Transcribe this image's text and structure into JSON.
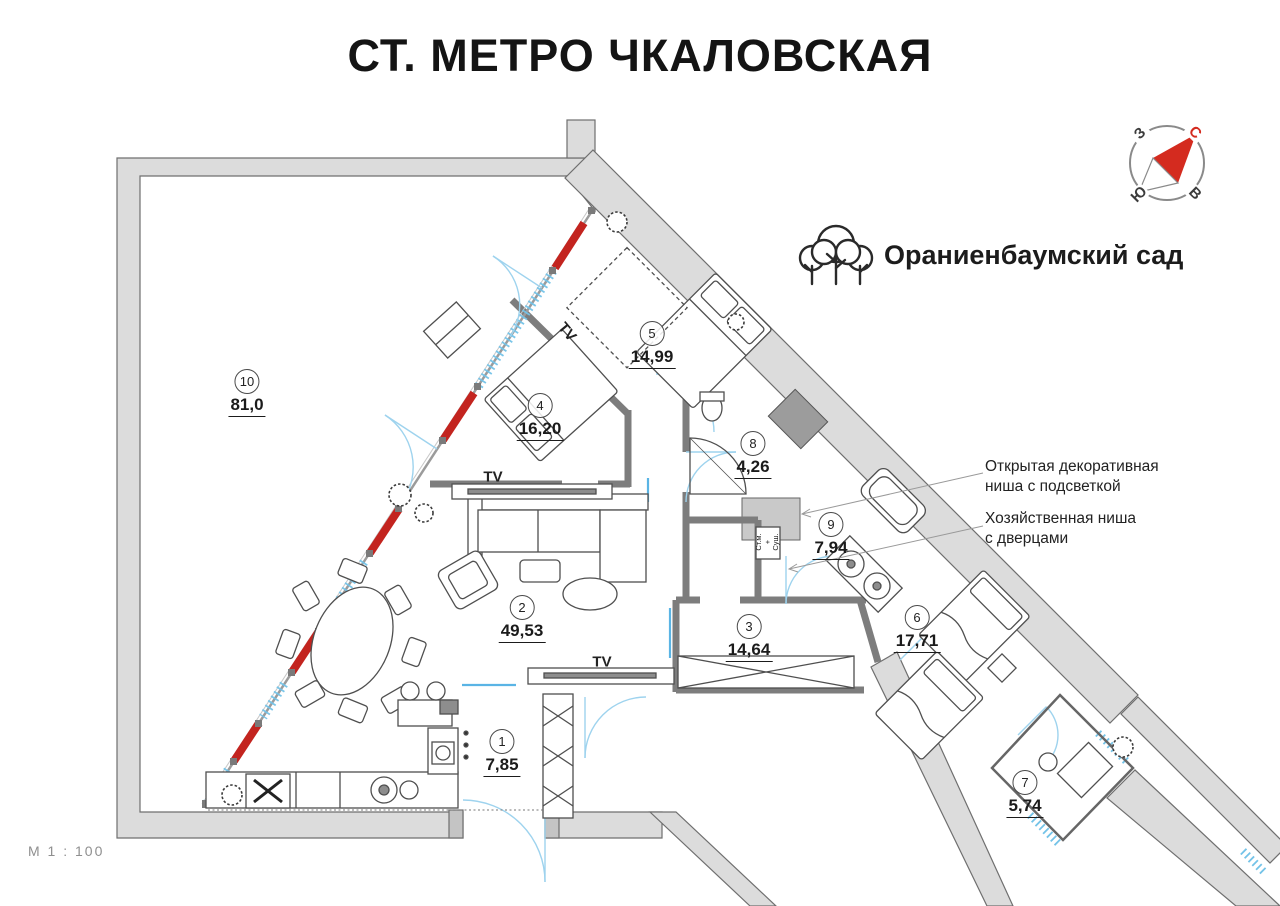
{
  "title": "СТ. МЕТРО ЧКАЛОВСКАЯ",
  "landmark": {
    "label": "Ораниенбаумский сад",
    "icon": "trees-icon"
  },
  "compass": {
    "north": "С",
    "south": "Ю",
    "west": "З",
    "east": "В"
  },
  "scale_note": "М 1 : 100",
  "rooms": [
    {
      "num": "1",
      "area": "7,85"
    },
    {
      "num": "2",
      "area": "49,53"
    },
    {
      "num": "3",
      "area": "14,64"
    },
    {
      "num": "4",
      "area": "16,20"
    },
    {
      "num": "5",
      "area": "14,99"
    },
    {
      "num": "6",
      "area": "17,71"
    },
    {
      "num": "7",
      "area": "5,74"
    },
    {
      "num": "8",
      "area": "4,26"
    },
    {
      "num": "9",
      "area": "7,94"
    },
    {
      "num": "10",
      "area": "81,0"
    }
  ],
  "annotations": [
    {
      "line1": "Открытая декоративная",
      "line2": "ниша с подсветкой"
    },
    {
      "line1": "Хозяйственная ниша",
      "line2": "с дверцами"
    }
  ],
  "equipment": {
    "tv": "TV",
    "washer_dryer": "Ст.м.\n+\nСуш."
  },
  "colors": {
    "facade_red": "#c3241f",
    "window_blue": "#74c3e8",
    "wall_fill": "#dcdcdc",
    "wall_edge": "#6f6f6f",
    "north_red": "#d42b1f"
  }
}
